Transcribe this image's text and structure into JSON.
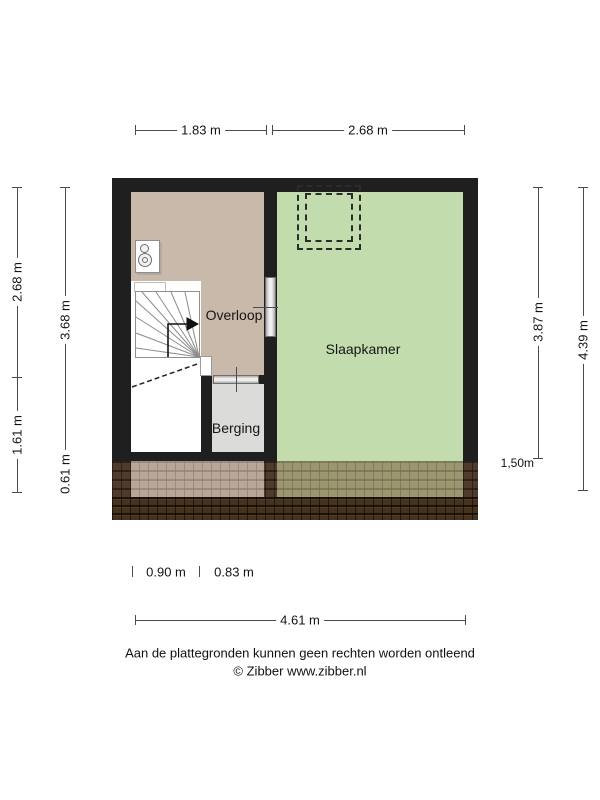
{
  "plan_type": "floor-plan",
  "rooms": [
    {
      "label": "Overloop"
    },
    {
      "label": "Slaapkamer"
    },
    {
      "label": "Berging"
    }
  ],
  "dims": {
    "top": [
      {
        "label": "1.83 m"
      },
      {
        "label": "2.68 m"
      }
    ],
    "left": [
      {
        "label": "2.68 m"
      },
      {
        "label": "1.61 m"
      },
      {
        "label": "3.68 m"
      },
      {
        "label": "0.61 m"
      }
    ],
    "right": [
      {
        "label": "3.87 m"
      },
      {
        "label": "4.39 m"
      },
      {
        "label": "1,50m"
      }
    ],
    "bottom": [
      {
        "label": "0.90 m"
      },
      {
        "label": "0.83 m"
      },
      {
        "label": "4.61 m"
      }
    ]
  },
  "footer": {
    "disclaimer": "Aan de plattegronden kunnen geen rechten worden ontleend",
    "copyright": "© Zibber www.zibber.nl"
  },
  "icons": {
    "toilet": "toilet-top-view-icon",
    "skylight": "roof-window-dashed-icon",
    "stairs": "winder-staircase-icon",
    "direction_arrow": "stair-direction-arrow-icon",
    "roof": "roof-tiles-pattern"
  },
  "colors": {
    "wall": "#1f1f1f",
    "overloop": "#c8b9aa",
    "slaapkamer": "#c3dcae",
    "berging": "#dbdbd9",
    "tile": "#7d5537",
    "tile-dark": "#46331f",
    "dim": "#4a4a4a",
    "text": "#141414"
  }
}
